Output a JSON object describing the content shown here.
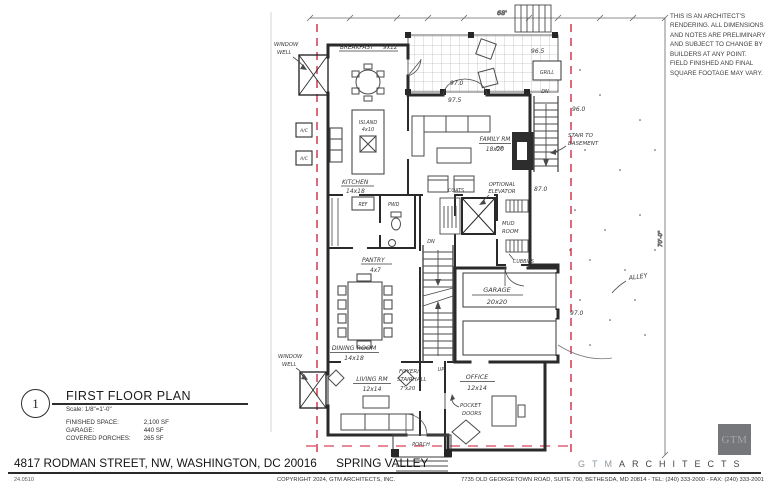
{
  "disclaimer": "THIS IS AN ARCHITECT'S RENDERING. ALL DIMENSIONS AND NOTES ARE PRELIMINARY AND SUBJECT TO CHANGE BY BUILDERS AT ANY POINT. FIELD FINISHED AND FINAL SQUARE FOOTAGE MAY VARY.",
  "title_block": {
    "detail_number": "1",
    "title": "FIRST FLOOR PLAN",
    "scale": "Scale: 1/8\"=1'-0\"",
    "stats": [
      {
        "label": "FINISHED SPACE:",
        "value": "2,100 SF"
      },
      {
        "label": "GARAGE:",
        "value": "440 SF"
      },
      {
        "label": "COVERED PORCHES:",
        "value": "265 SF"
      }
    ]
  },
  "address_bar": {
    "address": "4817 RODMAN STREET, NW, WASHINGTON, DC 20016",
    "neighborhood": "SPRING VALLEY",
    "project_number": "24.0510"
  },
  "footer": {
    "copyright": "COPYRIGHT 2024, GTM ARCHITECTS, INC.",
    "office": "7735 OLD GEORGETOWN ROAD, SUITE 700, BETHESDA, MD 20814 - TEL: (240) 333-2000 - FAX: (240) 333-2001",
    "logo_text": "GTM",
    "brand_gtm": "GTM",
    "brand_architects": "ARCHITECTS"
  },
  "colors": {
    "property_line_red": "#d6455b",
    "ink": "#2a2a2a",
    "logo_square_gray": "#76777a",
    "brand_gtm_gray": "#8d99a2"
  },
  "plan": {
    "dimensions": {
      "top": "68'",
      "right": "70'-0\""
    },
    "rooms": {
      "breakfast_name": "BREAKFAST",
      "breakfast_size": "9x12",
      "kitchen_name": "KITCHEN",
      "kitchen_size": "14x18",
      "island_name": "ISLAND",
      "island_size": "4x10",
      "family_name": "FAMILY RM",
      "family_size": "18x20",
      "dining_name": "DINING ROOM",
      "dining_size": "14x18",
      "living_name": "LIVING RM",
      "living_size": "12x14",
      "office_name": "OFFICE",
      "office_size": "12x14",
      "garage_name": "GARAGE",
      "garage_size": "20x20",
      "pantry_name": "PANTRY",
      "pantry_size": "4x7",
      "foyer_name1": "FOYER/",
      "foyer_name2": "STAIRHALL",
      "foyer_size": "7'x20",
      "mud_name1": "MUD",
      "mud_name2": "ROOM",
      "porch": "PORCH",
      "powder": "PWD"
    },
    "annotations": {
      "window_well_1a": "WINDOW",
      "window_well_1b": "WELL",
      "window_well_2a": "WINDOW",
      "window_well_2b": "WELL",
      "ac1": "A/C",
      "ac2": "A/C",
      "ref": "REF",
      "grill": "GRILL",
      "stair_basement_1": "STAIR TO",
      "stair_basement_2": "BASEMENT",
      "elevator_1": "OPTIONAL",
      "elevator_2": "ELEVATOR",
      "coats": "COATS",
      "cubbies": "CUBBIES",
      "pocket_1": "POCKET",
      "pocket_2": "DOORS",
      "fireplace": "F.P.",
      "dn_center": "DN",
      "dn_right": "DN",
      "up_center": "UP",
      "alley": "ALLEY"
    },
    "elevations": {
      "deck_upper": "97.0",
      "deck_lower": "97.5",
      "deck_right": "96.5",
      "east_upper": "96.0",
      "east_mid": "87.0",
      "east_garage": "97.0"
    }
  }
}
